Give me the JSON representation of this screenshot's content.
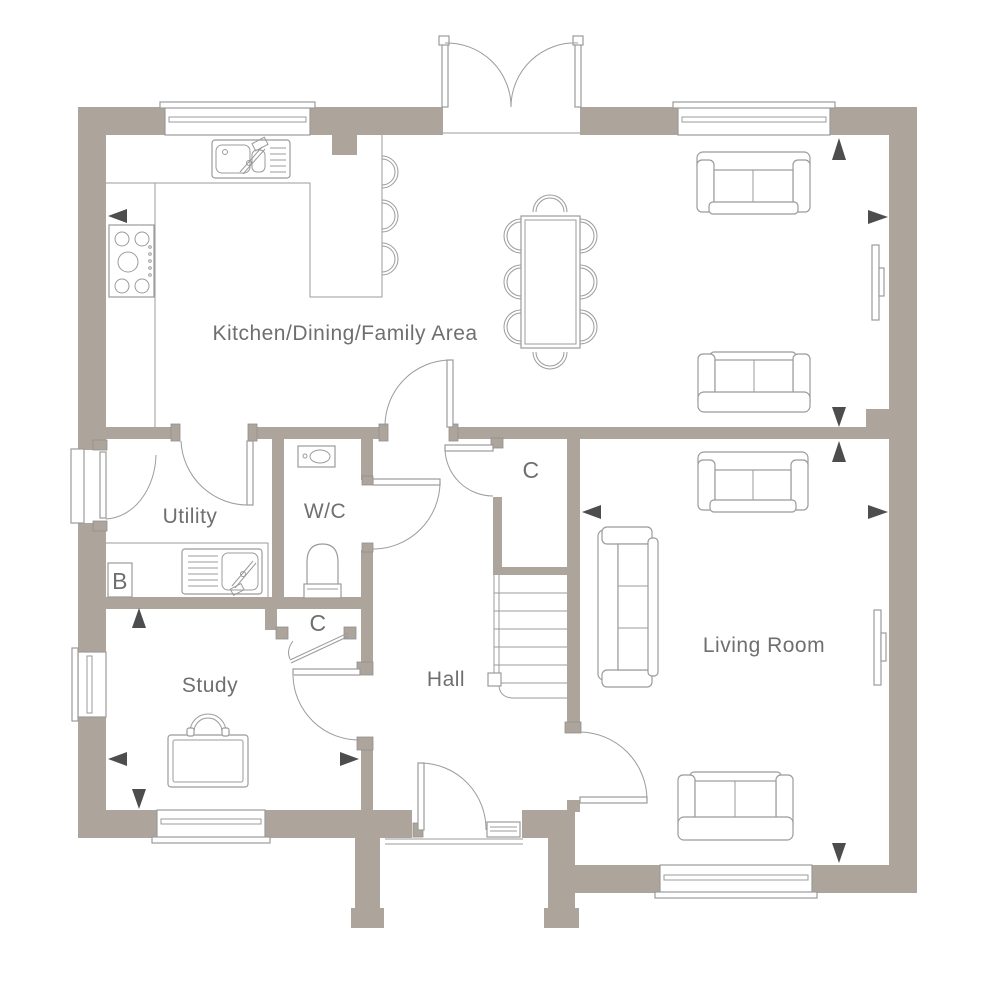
{
  "title": "Ground Floor Plan",
  "colors": {
    "wall": "#ada49b",
    "line": "#9b9b9b",
    "text": "#6f6f6f",
    "arrow": "#4d4d4d",
    "background": "#ffffff"
  },
  "rooms": {
    "kitchen": {
      "label": "Kitchen/Dining/Family Area"
    },
    "utility": {
      "label": "Utility"
    },
    "wc": {
      "label": "W/C"
    },
    "study": {
      "label": "Study"
    },
    "hall": {
      "label": "Hall"
    },
    "living": {
      "label": "Living Room"
    },
    "cupboard_hall": {
      "label": "C"
    },
    "cupboard_study": {
      "label": "C"
    },
    "boiler": {
      "label": "B"
    }
  },
  "icons": {
    "dimension_arrow": "filled-triangle",
    "door_swing": "quarter-arc",
    "window": "double-glazing-lines"
  }
}
